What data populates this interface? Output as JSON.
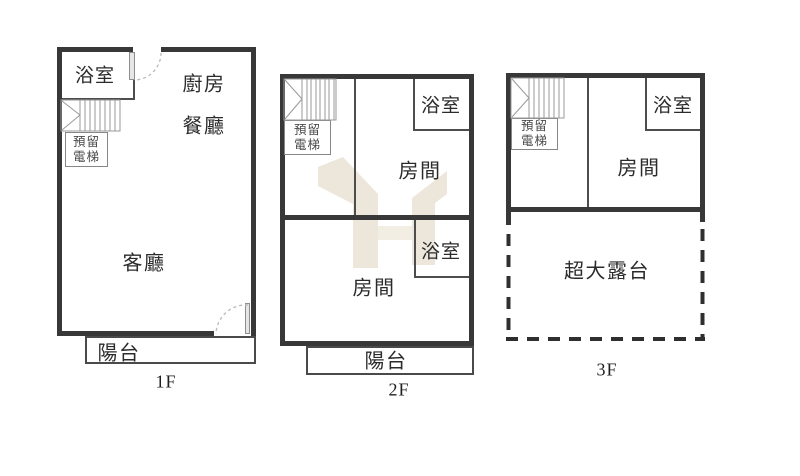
{
  "diagram_type": "floor-plan",
  "colors": {
    "wall": "#383838",
    "interior_wall": "#4d4d4d",
    "stair_lines": "#9a9a9a",
    "door_arc": "#b9b9b9",
    "watermark": "#ece7da",
    "text": "#2b2b2b",
    "background": "#ffffff"
  },
  "floors": [
    {
      "floor_label": "1F",
      "rooms": {
        "bathroom": "浴室",
        "kitchen": "廚房",
        "dining": "餐廳",
        "living": "客廳",
        "balcony": "陽台"
      },
      "elevator": {
        "line1": "預留",
        "line2": "電梯"
      }
    },
    {
      "floor_label": "2F",
      "rooms": {
        "bathroom_upper": "浴室",
        "room_upper": "房間",
        "bathroom_lower": "浴室",
        "room_lower": "房間",
        "balcony": "陽台"
      },
      "elevator": {
        "line1": "預留",
        "line2": "電梯"
      }
    },
    {
      "floor_label": "3F",
      "rooms": {
        "bathroom": "浴室",
        "room": "房間",
        "terrace": "超大露台"
      },
      "elevator": {
        "line1": "預留",
        "line2": "電梯"
      }
    }
  ]
}
